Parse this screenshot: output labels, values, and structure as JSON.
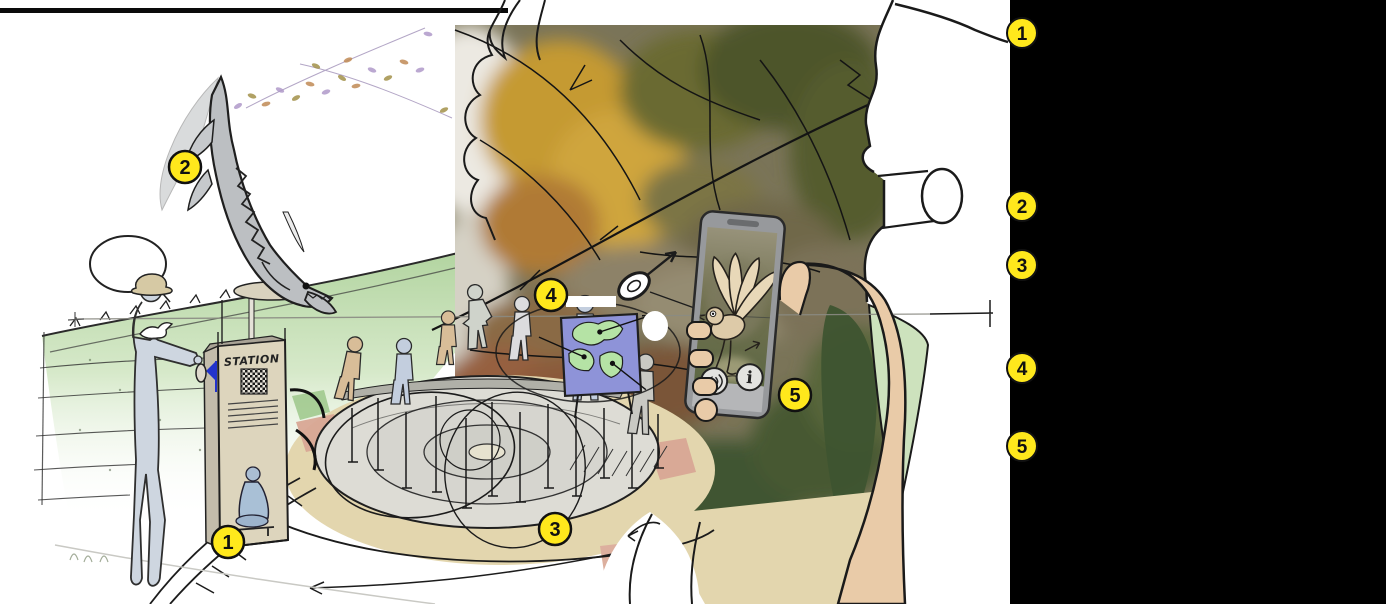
{
  "scene": {
    "markers": [
      {
        "label": "1"
      },
      {
        "label": "2"
      },
      {
        "label": "3"
      },
      {
        "label": "4"
      },
      {
        "label": "5"
      }
    ],
    "kiosk": {
      "title": "STATION"
    },
    "phone": {
      "buttons": [
        {
          "icon": "speaker-icon",
          "label": ""
        },
        {
          "icon": "info-icon",
          "label": "i"
        }
      ]
    }
  },
  "sidebar": {
    "background": "#000000",
    "legend": [
      {
        "label": "1"
      },
      {
        "label": "2"
      },
      {
        "label": "3"
      },
      {
        "label": "4"
      },
      {
        "label": "5"
      }
    ]
  },
  "colors": {
    "marker_yellow": "#ffe81c",
    "marker_border": "#111111",
    "watercolor_green": "#b9d6a6",
    "path_tan": "#e3d6ae",
    "panel_blue": "#8e93d8",
    "panel_map_green": "#b5e3a5"
  }
}
